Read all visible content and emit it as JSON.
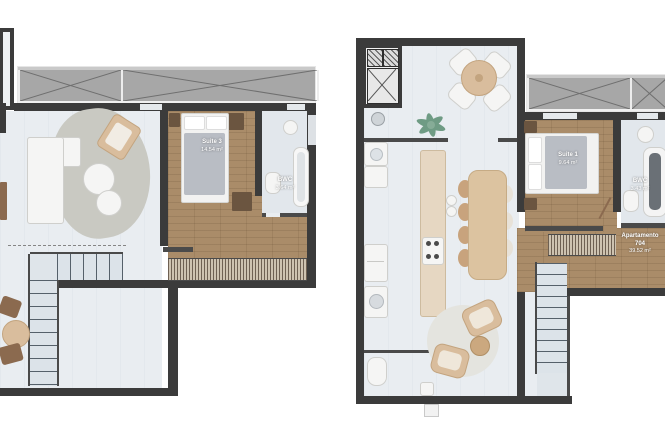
{
  "plans": {
    "left": {
      "rooms": [
        {
          "name": "Suite 3",
          "area": "14.54 m²"
        },
        {
          "name": "BWC",
          "area": "3.64 m²"
        }
      ]
    },
    "right": {
      "rooms": [
        {
          "name": "Suite 1",
          "area": "9.64 m²"
        },
        {
          "name": "BWC",
          "area": "3.43 m²"
        }
      ],
      "apartment": {
        "title": "Apartamento",
        "number": "704",
        "area": "39.52 m²"
      }
    }
  },
  "colors": {
    "wall": "#3b3b3b",
    "floor_light": "#e9edf1",
    "floor_wood": "#aa8c69",
    "balcony_gray": "#a7a7a7",
    "rug_gray": "#c9c9c2",
    "furniture_tan": "#d9bd9d",
    "blanket_gray": "#b9bdc4",
    "plant_green": "#6f9b84",
    "label_text": "#ffffff"
  }
}
